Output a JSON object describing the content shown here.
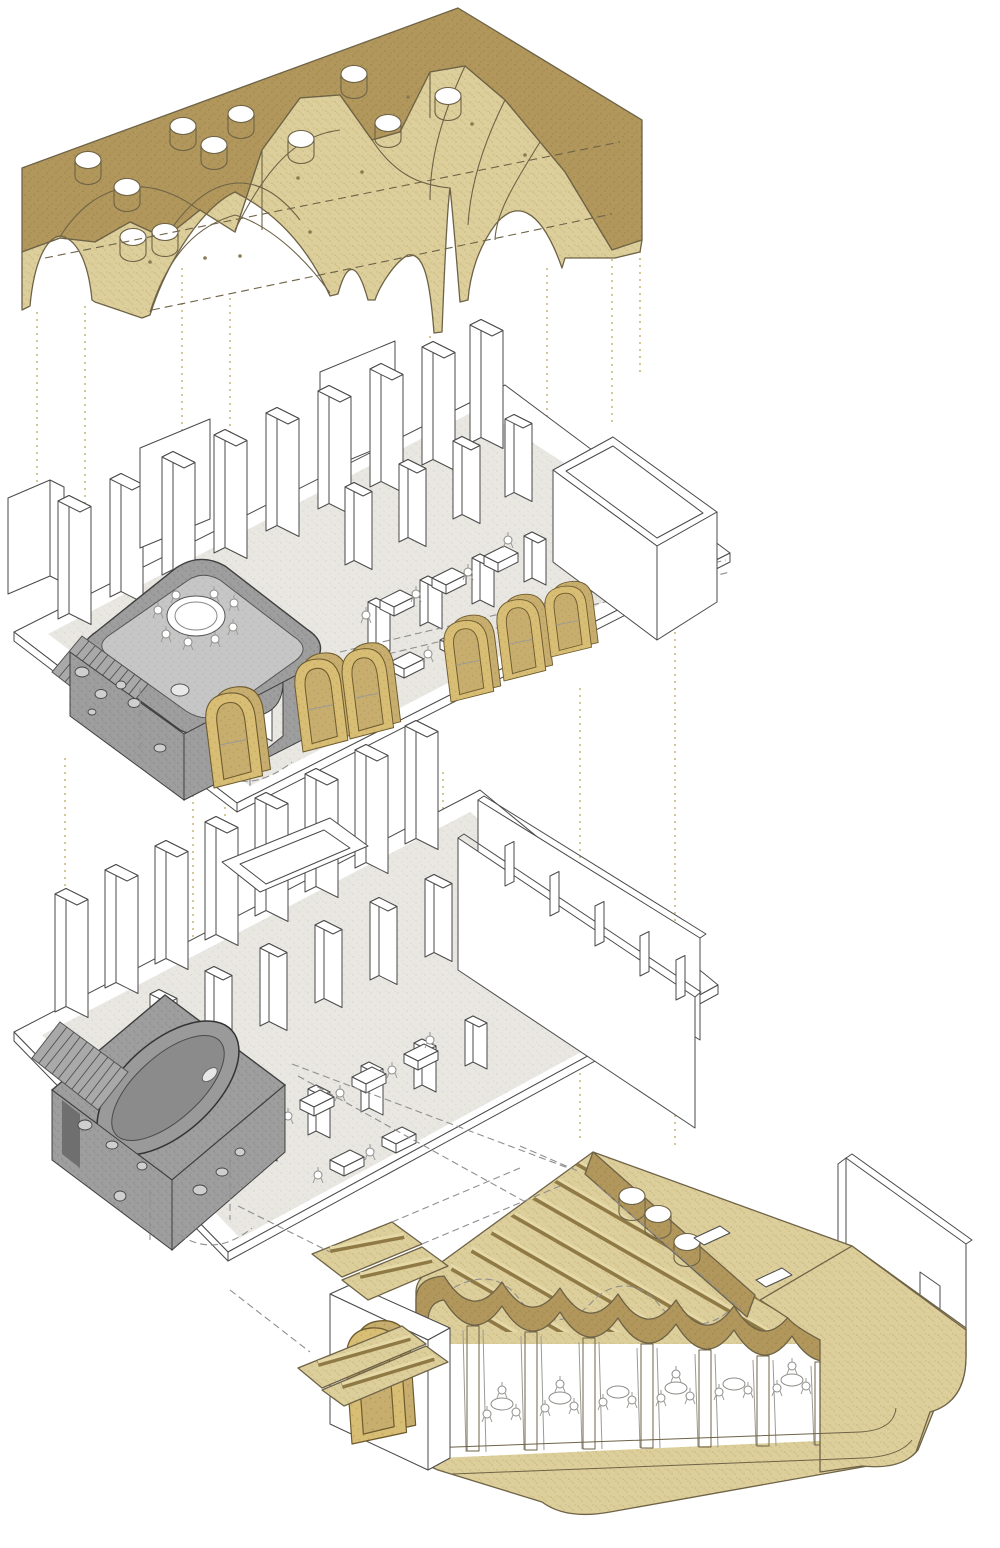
{
  "diagram": {
    "type": "exploded-axonometric-architecture",
    "layers": [
      {
        "id": "vaulted-ceiling",
        "skylight_count": 11
      },
      {
        "id": "upper-floor-plan",
        "arch_frame_count": 6,
        "stone_room": "rounded-box-with-round-table-stair-portholes"
      },
      {
        "id": "lower-floor-plan",
        "stone_room": "box-with-oval-tub-stair-portholes"
      },
      {
        "id": "ground-floor-section",
        "roof_hole_count": 3,
        "vault_bay_count": 7
      }
    ]
  },
  "colors": {
    "white": "#ffffff",
    "tan_light": "#ddcf9b",
    "tan_light_dot": "#c8b376",
    "tan_dark": "#b1975b",
    "tan_dark_dot": "#9d8347",
    "tan_mid": "#c7ae6e",
    "tan_mid_dot": "#b39656",
    "frame_tan": "#d8bd74",
    "frame_tan_dot": "#c5a75c",
    "gray_box": "#9e9e9e",
    "gray_box_dot": "#878787",
    "gray_light": "#c6c6c6",
    "gray_light_dot": "#b3b3b3",
    "floor_gray": "#e9e7e2",
    "floor_gray_dot": "#d7d3ca",
    "hole_fill": "#cfcfcf",
    "line_dark": "#4a4a4a",
    "outline_tan": "#6e6347",
    "dash_gray": "#8f8f8f",
    "dot_tan": "#c9b97f",
    "joist_dark": "#8f7a45",
    "joist_light": "#e6d9a8",
    "stair_fill": "#a9a9a9",
    "gray_face": "#909090"
  }
}
